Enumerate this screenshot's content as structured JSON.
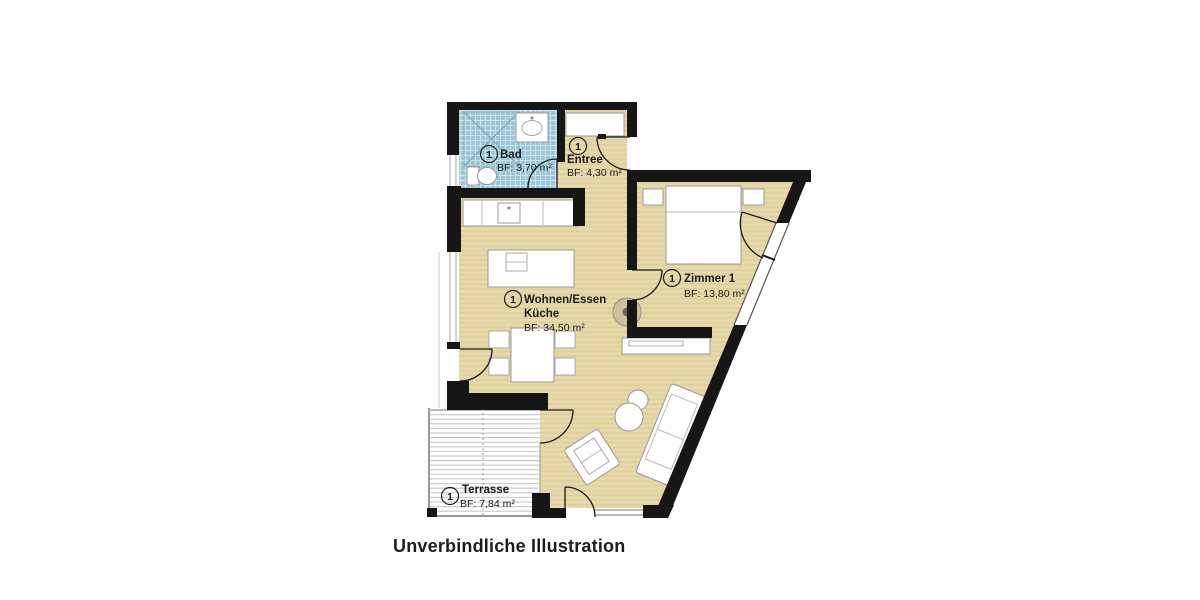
{
  "caption": "Unverbindliche Illustration",
  "rooms": [
    {
      "index": "1",
      "name": "Bad",
      "area": "BF: 3,70 m²"
    },
    {
      "index": "1",
      "name": "Entree",
      "area": "BF: 4,30 m²"
    },
    {
      "index": "1",
      "name": "Zimmer 1",
      "area": "BF: 13,80 m²"
    },
    {
      "index": "1",
      "name": "Wohnen/Essen",
      "name_line2": "Küche",
      "area": "BF: 34,50 m²"
    },
    {
      "index": "1",
      "name": "Terrasse",
      "area": "BF: 7,84 m²"
    }
  ],
  "colors": {
    "wall": "#161616",
    "floor_beige": "#e7d9aa",
    "floor_stripe": "#dfd19e",
    "bath_tile": "#9ac6d7",
    "tile_grid": "#c9e4ee",
    "deck_line": "#cccccc",
    "outline_gray": "#999999"
  }
}
